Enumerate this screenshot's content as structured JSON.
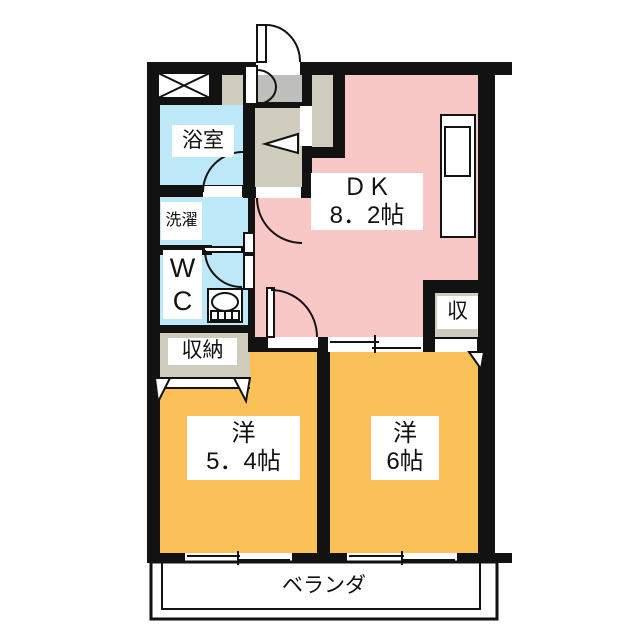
{
  "floorplan": {
    "type": "apartment-floor-plan",
    "colors": {
      "wall": "#121212",
      "dk": "#f8c8c6",
      "bedroom": "#fac159",
      "wet_area": "#bde8f7",
      "genkan": "#bebebc",
      "hallway": "#d0cdbe",
      "closet": "#cfccbd",
      "label_bg": "#ffffff"
    },
    "rooms": {
      "dk": {
        "name": "ＤＫ",
        "size": "8．2帖"
      },
      "western1": {
        "name": "洋",
        "size": "5．4帖"
      },
      "western2": {
        "name": "洋",
        "size": "6帖"
      },
      "bathroom": {
        "name": "浴室"
      },
      "laundry": {
        "name": "洗濯"
      },
      "wc": {
        "line1": "W",
        "line2": "C"
      },
      "closet_main": {
        "name": "収納"
      },
      "closet_small": {
        "name": "収"
      },
      "veranda": {
        "name": "ベランダ"
      }
    }
  }
}
